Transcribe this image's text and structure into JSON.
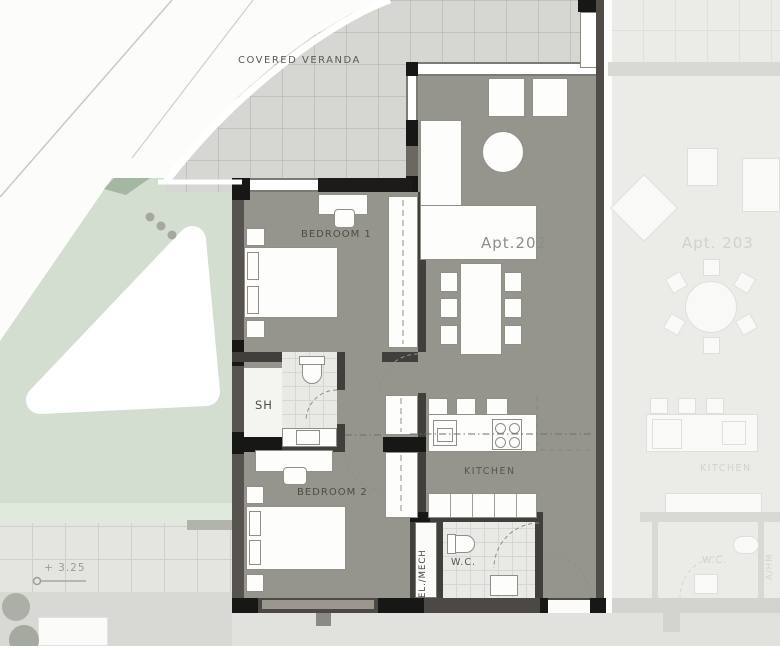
{
  "areas": {
    "veranda": {
      "label": "COVERED  VERANDA"
    },
    "apartment_202": {
      "label": "Apt.202",
      "rooms": {
        "bedroom_1": "BEDROOM  1",
        "bedroom_2": "BEDROOM  2",
        "shower": "SH",
        "kitchen": "KITCHEN",
        "wc": "W.C.",
        "electrical_mechanical": "EL./MECH"
      }
    },
    "apartment_203": {
      "label": "Apt. 203",
      "rooms": {
        "kitchen": "KITCHEN",
        "wc": "W.C.",
        "utility": "A/HM"
      }
    },
    "site": {
      "elevation_marker": "+ 3.25"
    }
  },
  "colors": {
    "apartment_floor": "#96958d",
    "adjacent_floor": "#ebebe8",
    "veranda_tile": "#d6d6d2",
    "wall_dark": "#413f3c",
    "wall_black": "#171715",
    "green_landscape": "#d3ddd0",
    "furniture_white": "#fdfdfc"
  }
}
